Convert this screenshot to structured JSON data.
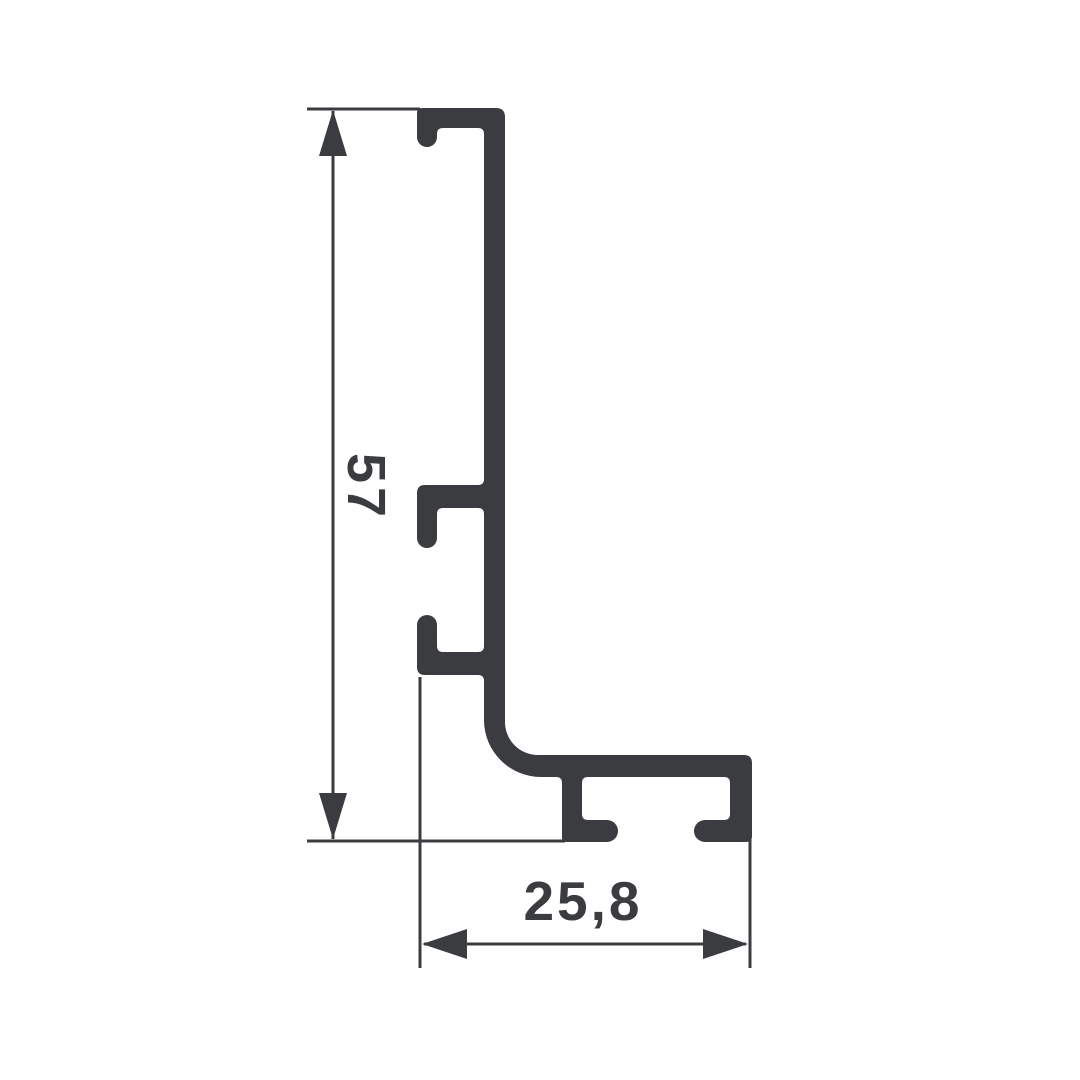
{
  "colors": {
    "background": "#ffffff",
    "profile": "#3a3c40",
    "line": "#3a3c40",
    "text": "#3a3c40"
  },
  "drawing": {
    "vertical_dimension": {
      "label": "57"
    },
    "horizontal_dimension": {
      "label": "25,8"
    }
  }
}
